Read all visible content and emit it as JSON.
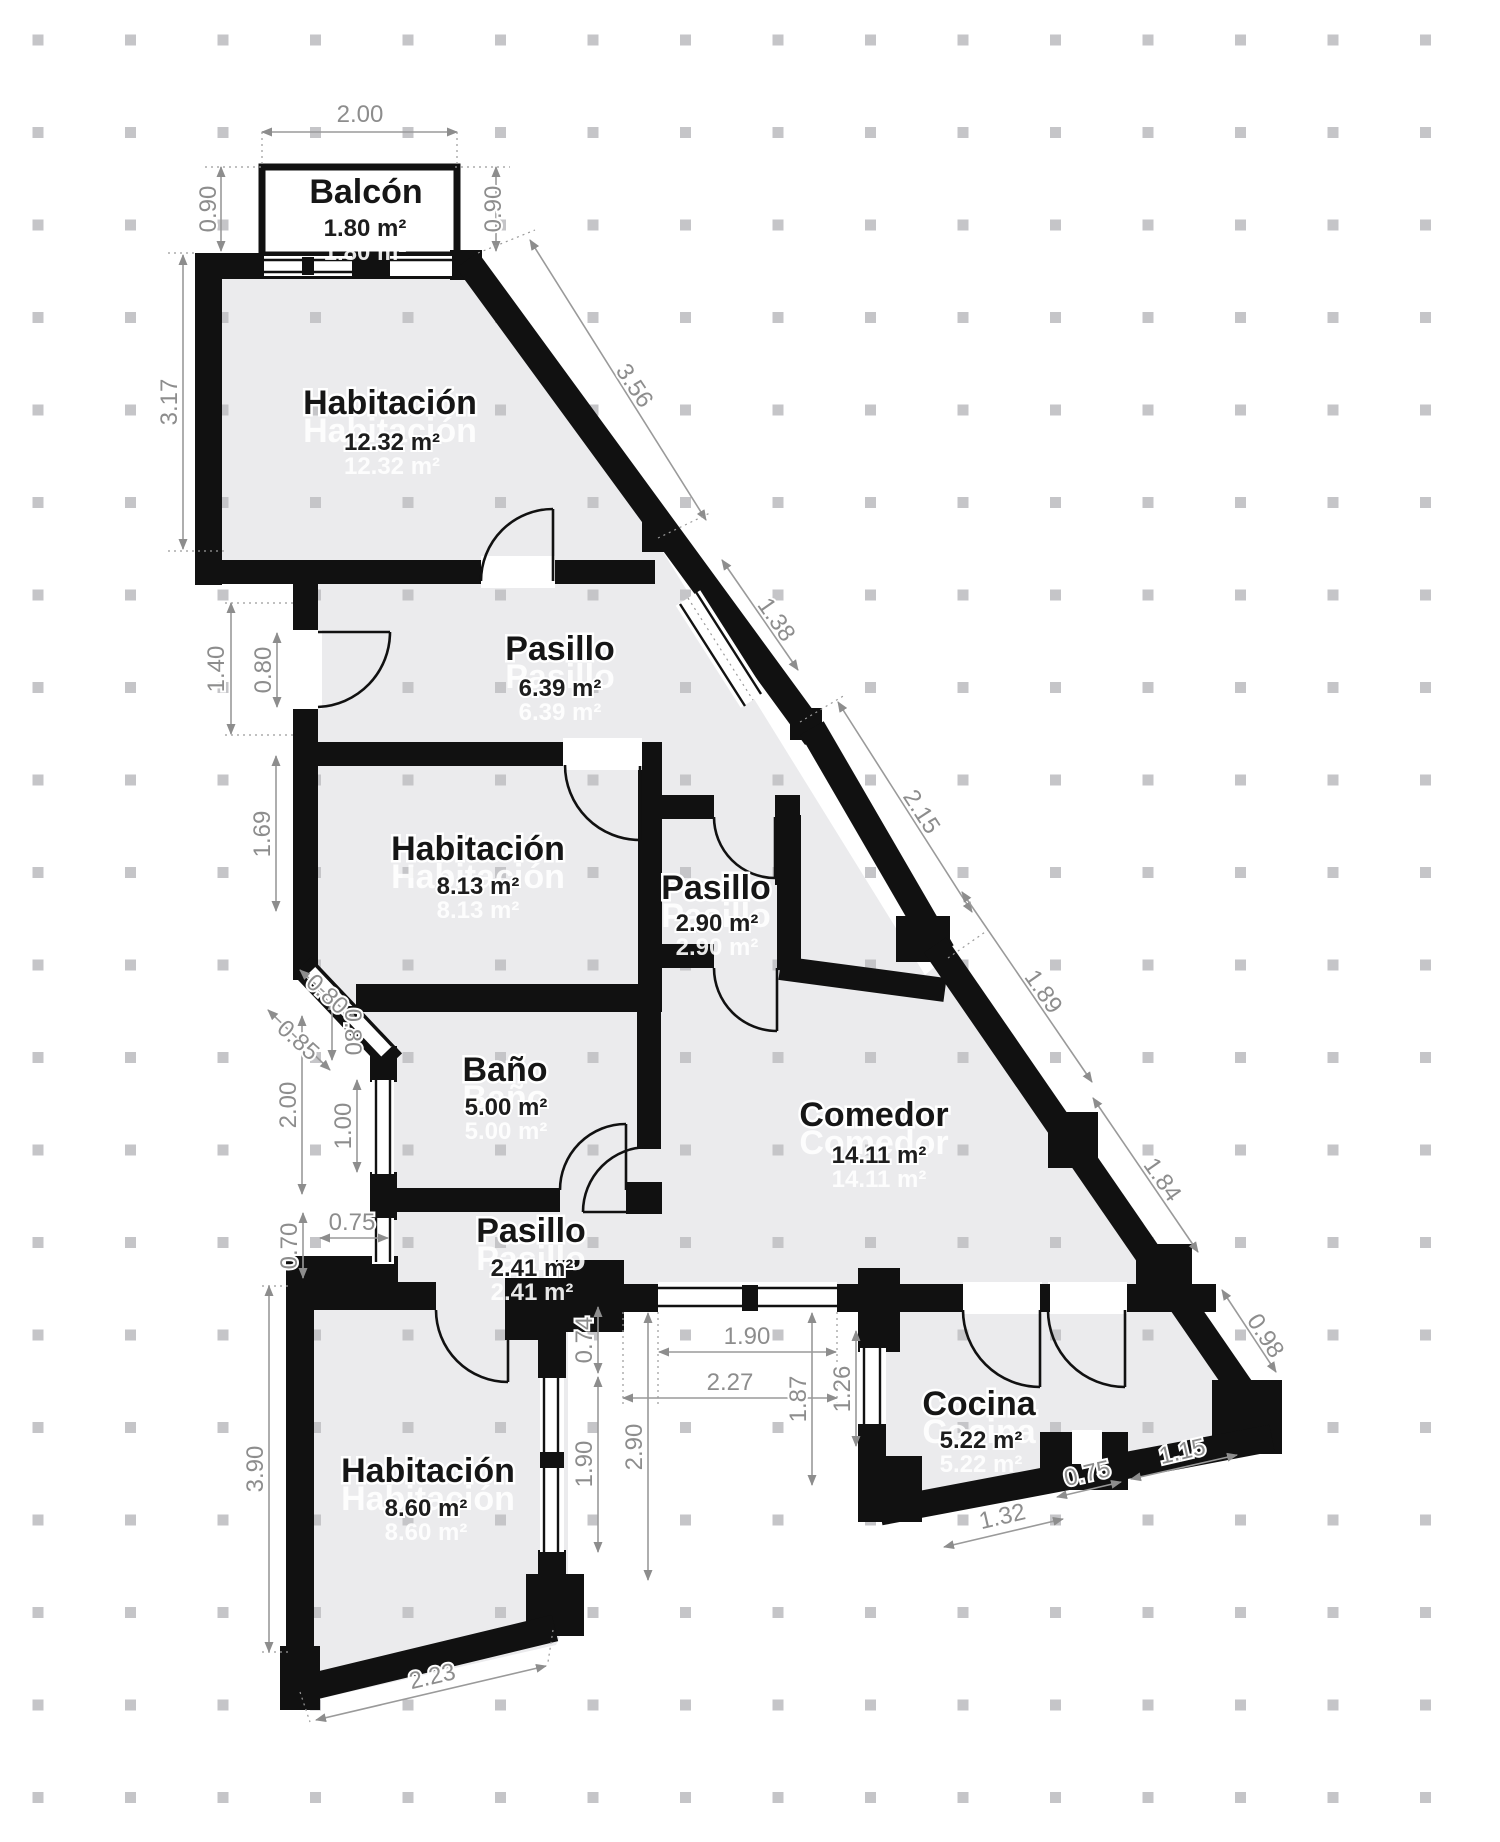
{
  "canvas": {
    "width": 1500,
    "height": 1842,
    "background": "#ffffff"
  },
  "colors": {
    "wall": "#111111",
    "room_fill": "#ebebed",
    "dimension": "#8d8d8d",
    "dimension_line": "#9a9a9a",
    "grid_dot": "#c5c5c8",
    "label": "#161616",
    "background": "#ffffff"
  },
  "rooms": [
    {
      "id": "balcon",
      "name": "Balcón",
      "area": "1.80 m²",
      "x": 366,
      "y": 203,
      "area_x": 365,
      "area_y": 236
    },
    {
      "id": "habitacion-1",
      "name": "Habitación",
      "area": "12.32 m²",
      "x": 390,
      "y": 414,
      "area_x": 392,
      "area_y": 450
    },
    {
      "id": "pasillo-1",
      "name": "Pasillo",
      "area": "6.39 m²",
      "x": 560,
      "y": 660,
      "area_x": 560,
      "area_y": 696
    },
    {
      "id": "habitacion-2",
      "name": "Habitación",
      "area": "8.13 m²",
      "x": 478,
      "y": 860,
      "area_x": 478,
      "area_y": 894
    },
    {
      "id": "pasillo-2",
      "name": "Pasillo",
      "area": "2.90 m²",
      "x": 716,
      "y": 899,
      "area_x": 717,
      "area_y": 931
    },
    {
      "id": "bano",
      "name": "Baño",
      "area": "5.00 m²",
      "x": 505,
      "y": 1081,
      "area_x": 506,
      "area_y": 1115
    },
    {
      "id": "comedor",
      "name": "Comedor",
      "area": "14.11 m²",
      "x": 874,
      "y": 1126,
      "area_x": 879,
      "area_y": 1163
    },
    {
      "id": "pasillo-3",
      "name": "Pasillo",
      "area": "2.41 m²",
      "x": 531,
      "y": 1242,
      "area_x": 532,
      "area_y": 1276
    },
    {
      "id": "habitacion-3",
      "name": "Habitación",
      "area": "8.60 m²",
      "x": 428,
      "y": 1482,
      "area_x": 426,
      "area_y": 1516
    },
    {
      "id": "cocina",
      "name": "Cocina",
      "area": "5.22 m²",
      "x": 979,
      "y": 1415,
      "area_x": 981,
      "area_y": 1448
    }
  ],
  "dimensions": [
    {
      "value": "2.00",
      "x": 360,
      "y": 122,
      "angle": 0
    },
    {
      "value": "0.90",
      "x": 216,
      "y": 209,
      "angle": -90
    },
    {
      "value": "0.90",
      "x": 501,
      "y": 209,
      "angle": -90
    },
    {
      "value": "3.17",
      "x": 177,
      "y": 402,
      "angle": -90
    },
    {
      "value": "3.56",
      "x": 628,
      "y": 390,
      "angle": 56
    },
    {
      "value": "1.38",
      "x": 770,
      "y": 624,
      "angle": 55
    },
    {
      "value": "2.15",
      "x": 915,
      "y": 816,
      "angle": 57
    },
    {
      "value": "1.89",
      "x": 1037,
      "y": 996,
      "angle": 55
    },
    {
      "value": "1.84",
      "x": 1156,
      "y": 1184,
      "angle": 55
    },
    {
      "value": "0.98",
      "x": 1259,
      "y": 1340,
      "angle": 57
    },
    {
      "value": "1.40",
      "x": 224,
      "y": 669,
      "angle": -90
    },
    {
      "value": "0.80",
      "x": 271,
      "y": 670,
      "angle": -90
    },
    {
      "value": "1.69",
      "x": 270,
      "y": 834,
      "angle": -90
    },
    {
      "value": "0.80",
      "x": 322,
      "y": 1000,
      "angle": 42
    },
    {
      "value": "0.85",
      "x": 293,
      "y": 1046,
      "angle": 42
    },
    {
      "value": "0.80",
      "x": 345,
      "y": 1032,
      "angle": 90
    },
    {
      "value": "2.00",
      "x": 296,
      "y": 1105,
      "angle": -90
    },
    {
      "value": "1.00",
      "x": 351,
      "y": 1126,
      "angle": -90
    },
    {
      "value": "0.70",
      "x": 297,
      "y": 1246,
      "angle": -90
    },
    {
      "value": "0.75",
      "x": 352,
      "y": 1230,
      "angle": 0
    },
    {
      "value": "3.90",
      "x": 263,
      "y": 1469,
      "angle": -90
    },
    {
      "value": "2.23",
      "x": 434,
      "y": 1684,
      "angle": -13
    },
    {
      "value": "0.74",
      "x": 592,
      "y": 1340,
      "angle": -90
    },
    {
      "value": "1.90",
      "x": 592,
      "y": 1464,
      "angle": -90
    },
    {
      "value": "2.90",
      "x": 642,
      "y": 1447,
      "angle": -90
    },
    {
      "value": "1.90",
      "x": 747,
      "y": 1344,
      "angle": 0
    },
    {
      "value": "2.27",
      "x": 730,
      "y": 1390,
      "angle": 0
    },
    {
      "value": "1.87",
      "x": 806,
      "y": 1399,
      "angle": -90
    },
    {
      "value": "1.26",
      "x": 850,
      "y": 1389,
      "angle": -90
    },
    {
      "value": "1.32",
      "x": 1004,
      "y": 1524,
      "angle": -13
    },
    {
      "value": "0.75",
      "x": 1089,
      "y": 1481,
      "angle": -13
    },
    {
      "value": "1.15",
      "x": 1184,
      "y": 1459,
      "angle": -13
    }
  ]
}
